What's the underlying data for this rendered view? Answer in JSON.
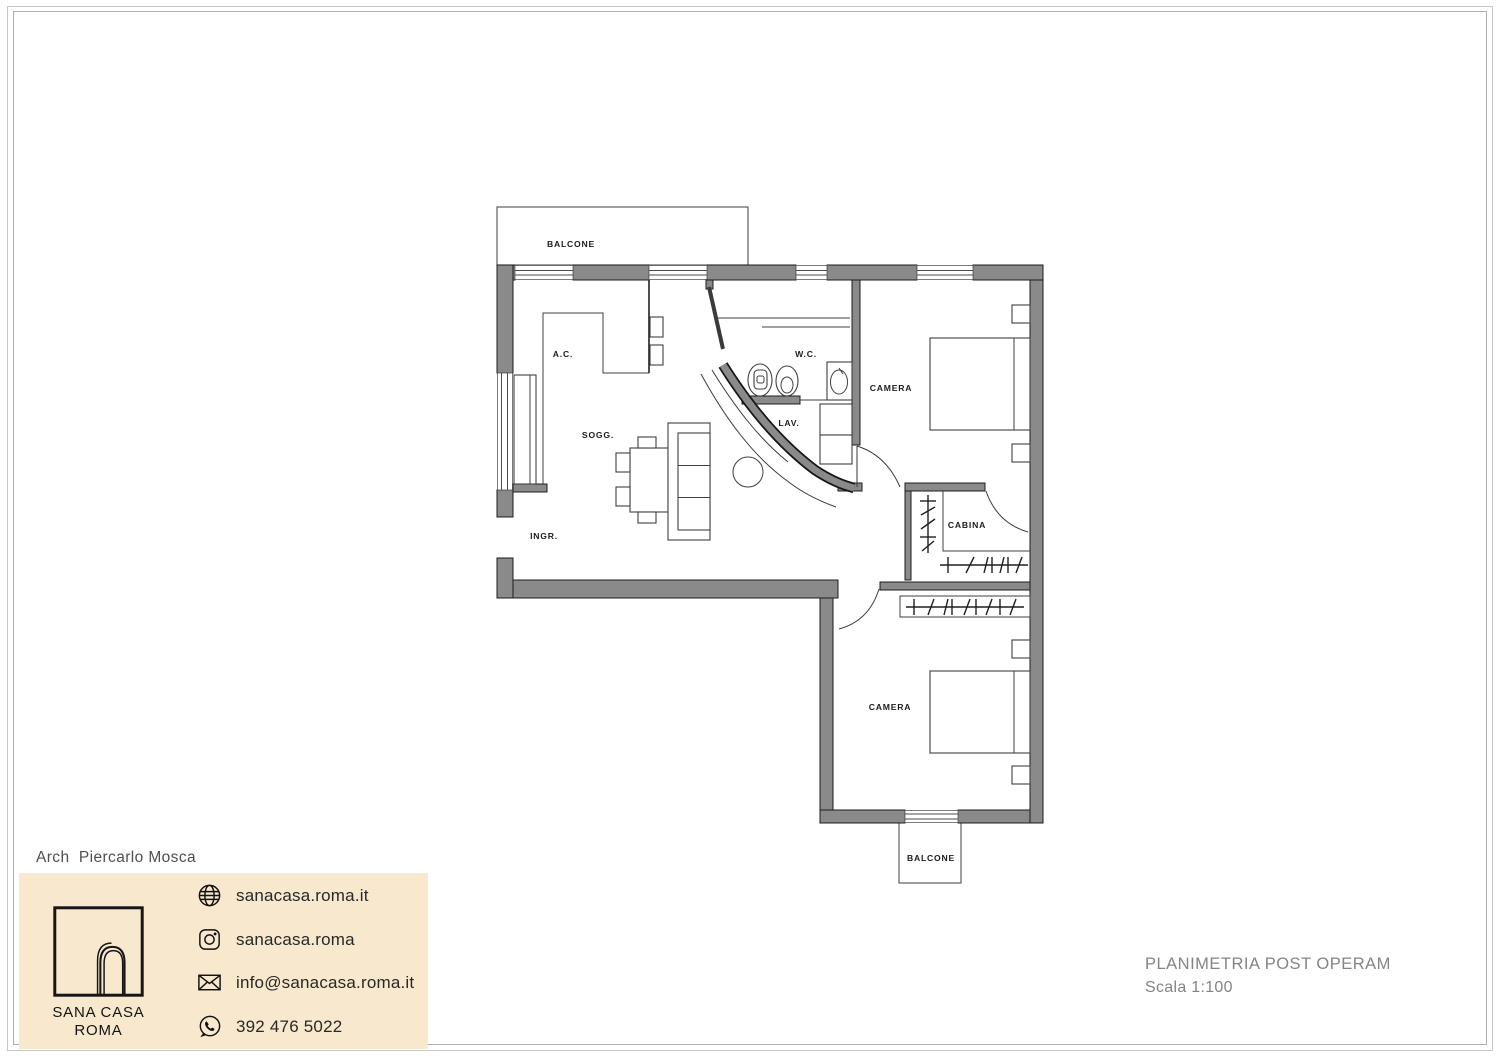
{
  "colors": {
    "wall": "#8a8a8a",
    "wall_outline": "#1c1c1c",
    "accent_box": "#f8e9ce",
    "line": "#3f3f3f",
    "label": "#1c1c1c",
    "muted_text": "#848484",
    "dark_text": "#282828"
  },
  "titleblock": {
    "architect": "Arch  Piercarlo Mosca",
    "brand_line1": "SANA CASA",
    "brand_line2": "ROMA",
    "contacts": [
      {
        "icon": "globe-icon",
        "label": "sanacasa.roma.it"
      },
      {
        "icon": "instagram-icon",
        "label": "sanacasa.roma"
      },
      {
        "icon": "email-icon",
        "label": "info@sanacasa.roma.it"
      },
      {
        "icon": "whatsapp-icon",
        "label": "392 476 5022"
      }
    ]
  },
  "drawing_info": {
    "title": "PLANIMETRIA POST OPERAM",
    "scale": "Scala 1:100"
  },
  "floorplan": {
    "labels": {
      "balcone_top": "BALCONE",
      "ac": "A.C.",
      "wc": "W.C.",
      "camera_top": "CAMERA",
      "sogg": "SOGG.",
      "lav": "LAV.",
      "ingr": "INGR.",
      "cabina": "CABINA",
      "camera_bottom": "CAMERA",
      "balcone_bottom": "BALCONE"
    }
  }
}
